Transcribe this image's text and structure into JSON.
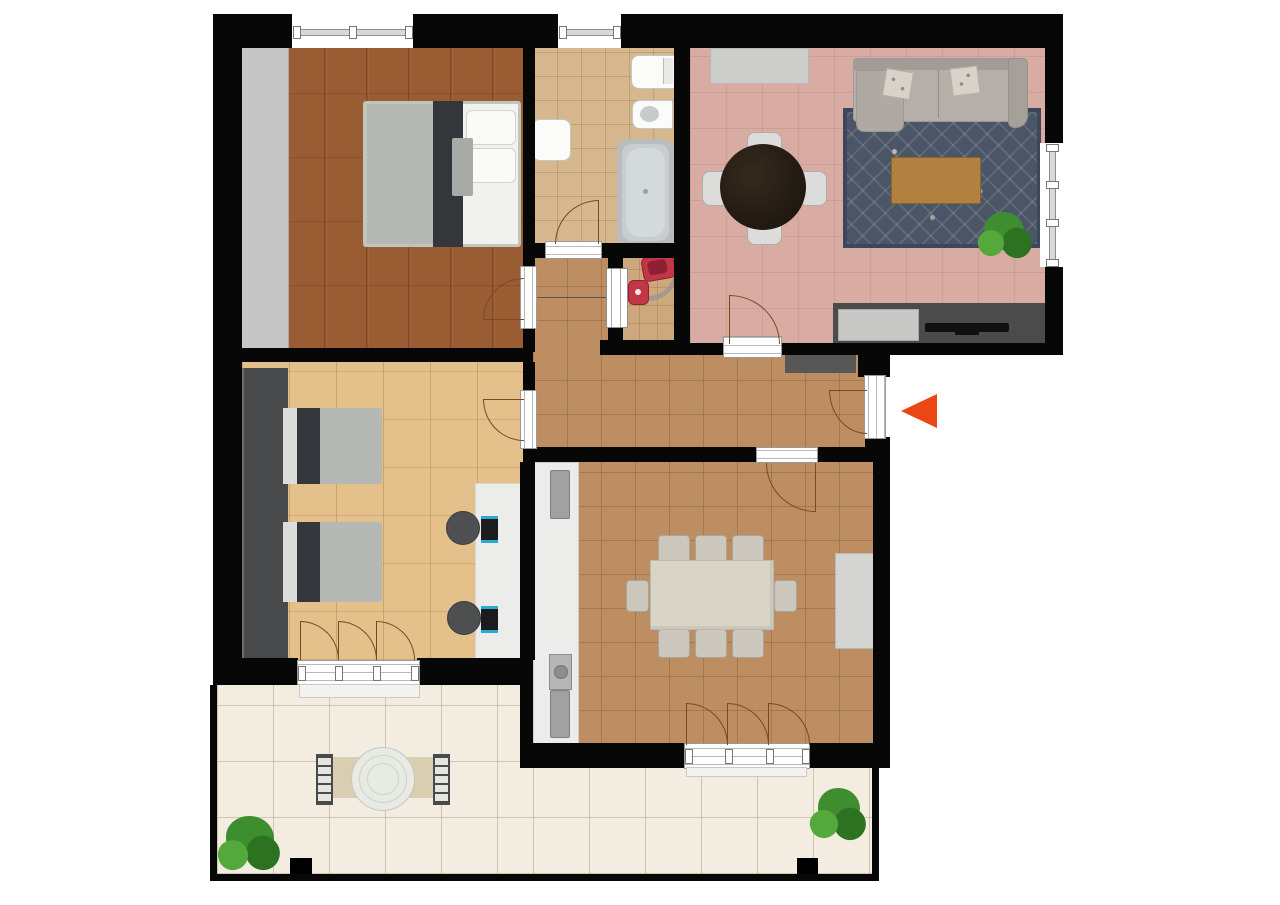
{
  "title": "apartment-floor-plan",
  "entrance": {
    "icon": "entrance-arrow-icon",
    "direction": "left"
  },
  "rooms": [
    {
      "id": "bedroom-1",
      "floor": "dark-wood-parquet",
      "furniture": [
        "double-bed",
        "wardrobe"
      ]
    },
    {
      "id": "bathroom",
      "floor": "beige-tile",
      "furniture": [
        "washbasin",
        "toilet",
        "bidet",
        "bathtub"
      ]
    },
    {
      "id": "wc-laundry",
      "floor": "beige-tile",
      "furniture": [
        "red-toilet",
        "red-washbasin"
      ],
      "door": "pocket-sliding-door"
    },
    {
      "id": "living-room",
      "floor": "rose-tile",
      "furniture": [
        "sideboard",
        "round-dining-table",
        "four-chairs",
        "sofa",
        "area-rug",
        "coffee-table",
        "potted-plant",
        "tv-lowboard",
        "tv"
      ]
    },
    {
      "id": "hallway",
      "floor": "terracotta-tile",
      "furniture": [
        "console-cabinet"
      ]
    },
    {
      "id": "bedroom-2",
      "floor": "light-wood",
      "furniture": [
        "wardrobe",
        "single-bed",
        "single-bed",
        "desk",
        "office-chair",
        "office-chair",
        "laptop",
        "laptop"
      ]
    },
    {
      "id": "kitchen-dining",
      "floor": "terracotta-tile",
      "furniture": [
        "kitchen-counter",
        "appliance",
        "washing-machine",
        "appliance",
        "dining-table",
        "eight-chairs",
        "cabinet"
      ]
    },
    {
      "id": "terrace",
      "floor": "cream-tile",
      "furniture": [
        "round-table",
        "bench",
        "bench",
        "outdoor-mat",
        "plant",
        "plant",
        "pillar",
        "pillar"
      ]
    }
  ],
  "colors": {
    "wall": "#070707",
    "bedroom1-floor": "#9a5c33",
    "bedroom2-floor": "#e4c08b",
    "bath-floor": "#d7b78e",
    "wc-floor": "#cda87c",
    "tile-floor": "#bd8e61",
    "lr-floor": "#d8aca3",
    "terrace-floor": "#f2ece1",
    "door-arc": "#7a4a1e",
    "window-line": "#8e8e8e",
    "arrow": "#ea4713",
    "wardrobe1": "#c6c6c6",
    "wardrobe2": "#47494b",
    "bed-frame": "#c2c6b8",
    "bed-gray": "#b5b8b5",
    "bed-dark": "#33363a",
    "bed-white": "#f1f1ef",
    "white-fixture": "#fbfbf9",
    "tub": "#b9bdbe",
    "red-fixture": "#c23748",
    "sofa": "#b4afa9",
    "rug": "#4a5568",
    "wood-table": "#b28142",
    "dark-table": "#201912",
    "tv-unit": "#4b4b4b",
    "hall-cabinet": "#575757",
    "sideboard": "#cdcdcb",
    "counter": "#ececea",
    "appliance": "#a0a1a1",
    "table-beige": "#d8d4c6",
    "chair-gray": "#dcdcda",
    "office-chair": "#4d4f51",
    "laptop-accent": "#2aa9d2",
    "plant-green": "#3e8d2e",
    "plant-dark": "#2d7220",
    "plant-light": "#55a83c",
    "mat": "#d9cdb2",
    "terrace-table": "#e8eae4",
    "pillar": "#000000"
  }
}
